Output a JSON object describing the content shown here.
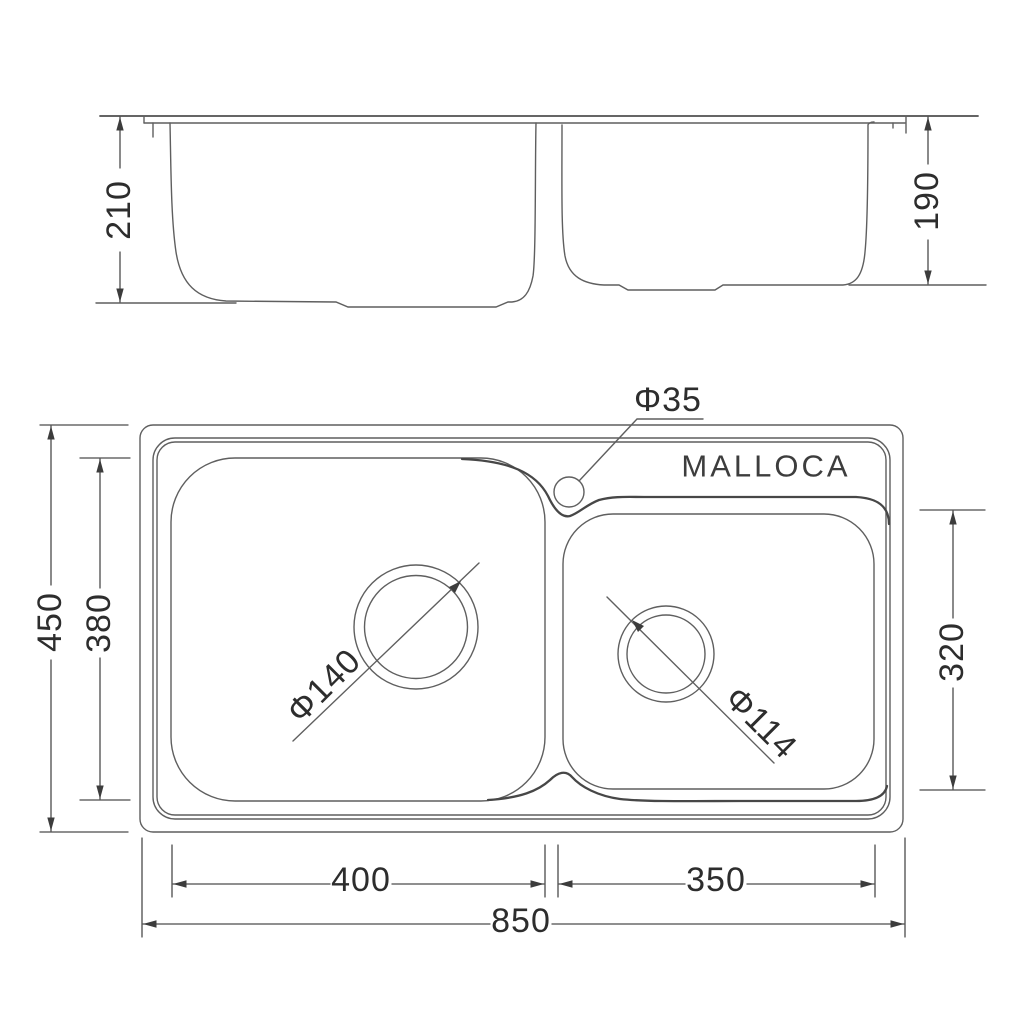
{
  "drawing": {
    "brand": "MALLOCA"
  },
  "elevation_view": {
    "left_bowl_depth": "210",
    "right_bowl_depth": "190"
  },
  "plan_view": {
    "brand_label": "MALLOCA",
    "faucet_hole_diameter": "Φ35",
    "left_drain_diameter": "Φ140",
    "right_drain_diameter": "Φ114",
    "overall_depth": "450",
    "left_bowl_inner_depth": "380",
    "right_bowl_inner_depth": "320",
    "left_bowl_inner_width": "400",
    "right_bowl_inner_width": "350",
    "overall_width": "850"
  },
  "colors": {
    "line": "#5f5f5f",
    "line_dark": "#474747",
    "text": "#2d2d2d",
    "background": "#ffffff"
  }
}
